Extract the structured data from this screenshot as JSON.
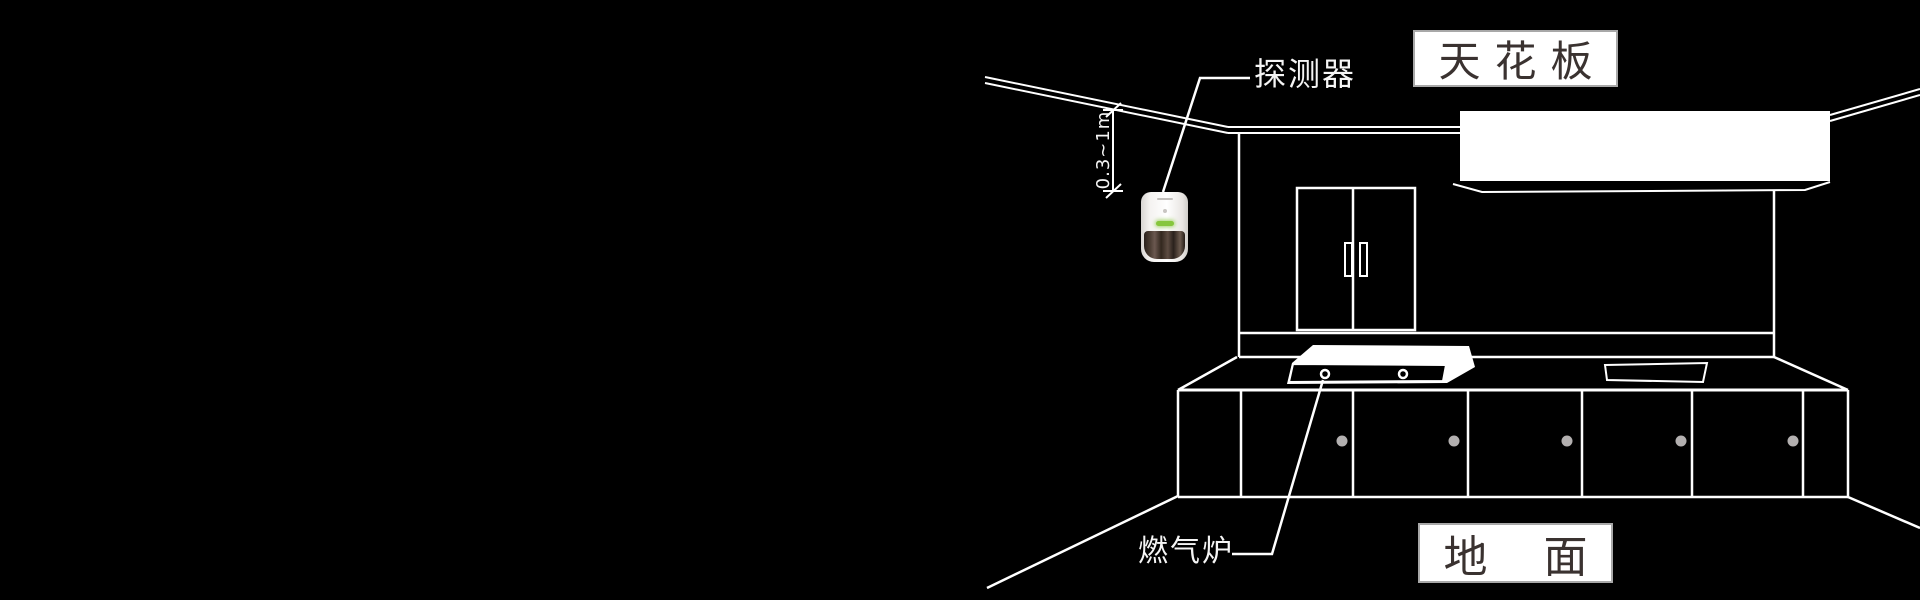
{
  "page": {
    "kind": "kitchen gas detector installation diagram",
    "background": "#000000",
    "width": 1920,
    "height": 600
  },
  "annotations": {
    "ceiling_box": {
      "text": "天花板"
    },
    "floor_box": {
      "text": "地    面"
    },
    "detector_label": {
      "text": "探测器"
    },
    "stove_label": {
      "text": "燃气炉"
    },
    "dimension_label": {
      "text": "0.3~1m"
    }
  },
  "colors": {
    "background": "#000000",
    "line": "#ffffff",
    "callout_box_fill": "#ffffff",
    "callout_box_border": "#a8a8a8",
    "callout_box_text": "#3a3230",
    "label_text": "#f5f5f5",
    "cabinet_knob": "#b3b0b0",
    "detector_led": "#86c63c",
    "detector_body": "#f2f0ee",
    "detector_window": "#3a2d24"
  }
}
